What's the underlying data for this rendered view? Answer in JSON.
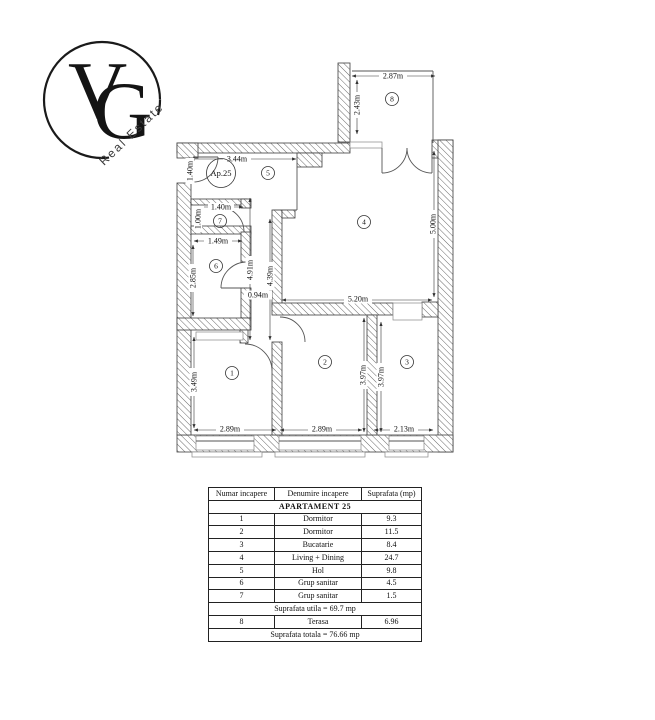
{
  "logo": {
    "letter_v": "V",
    "letter_g": "G",
    "tagline": "Real Estate"
  },
  "plan": {
    "apartment_label": "Ap.25",
    "room_numbers": {
      "bedroom1": "1",
      "bedroom2": "2",
      "kitchen": "3",
      "living": "4",
      "hol": "5",
      "wc": "6",
      "wc_small": "7",
      "terrace": "8"
    },
    "dimensions": {
      "terrace_width": "2.87m",
      "terrace_depth": "2.43m",
      "hol_width": "3.44m",
      "entrance_width": "1.40m",
      "wc_small_width": "1.40m",
      "wc_small_depth": "1.00m",
      "wc_width": "1.49m",
      "wc_depth": "2.85m",
      "hall_length_a": "4.91m",
      "hall_length_b": "4.39m",
      "hall_width": "0.94m",
      "living_width": "5.20m",
      "living_depth": "5.00m",
      "bedroom1_depth": "3.49m",
      "bedroom1_width": "2.89m",
      "bedroom2_width": "2.89m",
      "bedroom2_depth": "3.97m",
      "kitchen_depth": "3.97m",
      "kitchen_width": "2.13m"
    }
  },
  "table": {
    "headers": [
      "Numar incapere",
      "Denumire incapere",
      "Suprafata (mp)"
    ],
    "group_header": "APARTAMENT 25",
    "rows": [
      {
        "nr": "1",
        "name": "Dormitor",
        "area": "9.3"
      },
      {
        "nr": "2",
        "name": "Dormitor",
        "area": "11.5"
      },
      {
        "nr": "3",
        "name": "Bucatarie",
        "area": "8.4"
      },
      {
        "nr": "4",
        "name": "Living + Dining",
        "area": "24.7"
      },
      {
        "nr": "5",
        "name": "Hol",
        "area": "9.8"
      },
      {
        "nr": "6",
        "name": "Grup sanitar",
        "area": "4.5"
      },
      {
        "nr": "7",
        "name": "Grup sanitar",
        "area": "1.5"
      }
    ],
    "useful_area": "Suprafata utila = 69.7 mp",
    "terrace_row": {
      "nr": "8",
      "name": "Terasa",
      "area": "6.96"
    },
    "total_area": "Suprafata totala = 76.66 mp"
  }
}
